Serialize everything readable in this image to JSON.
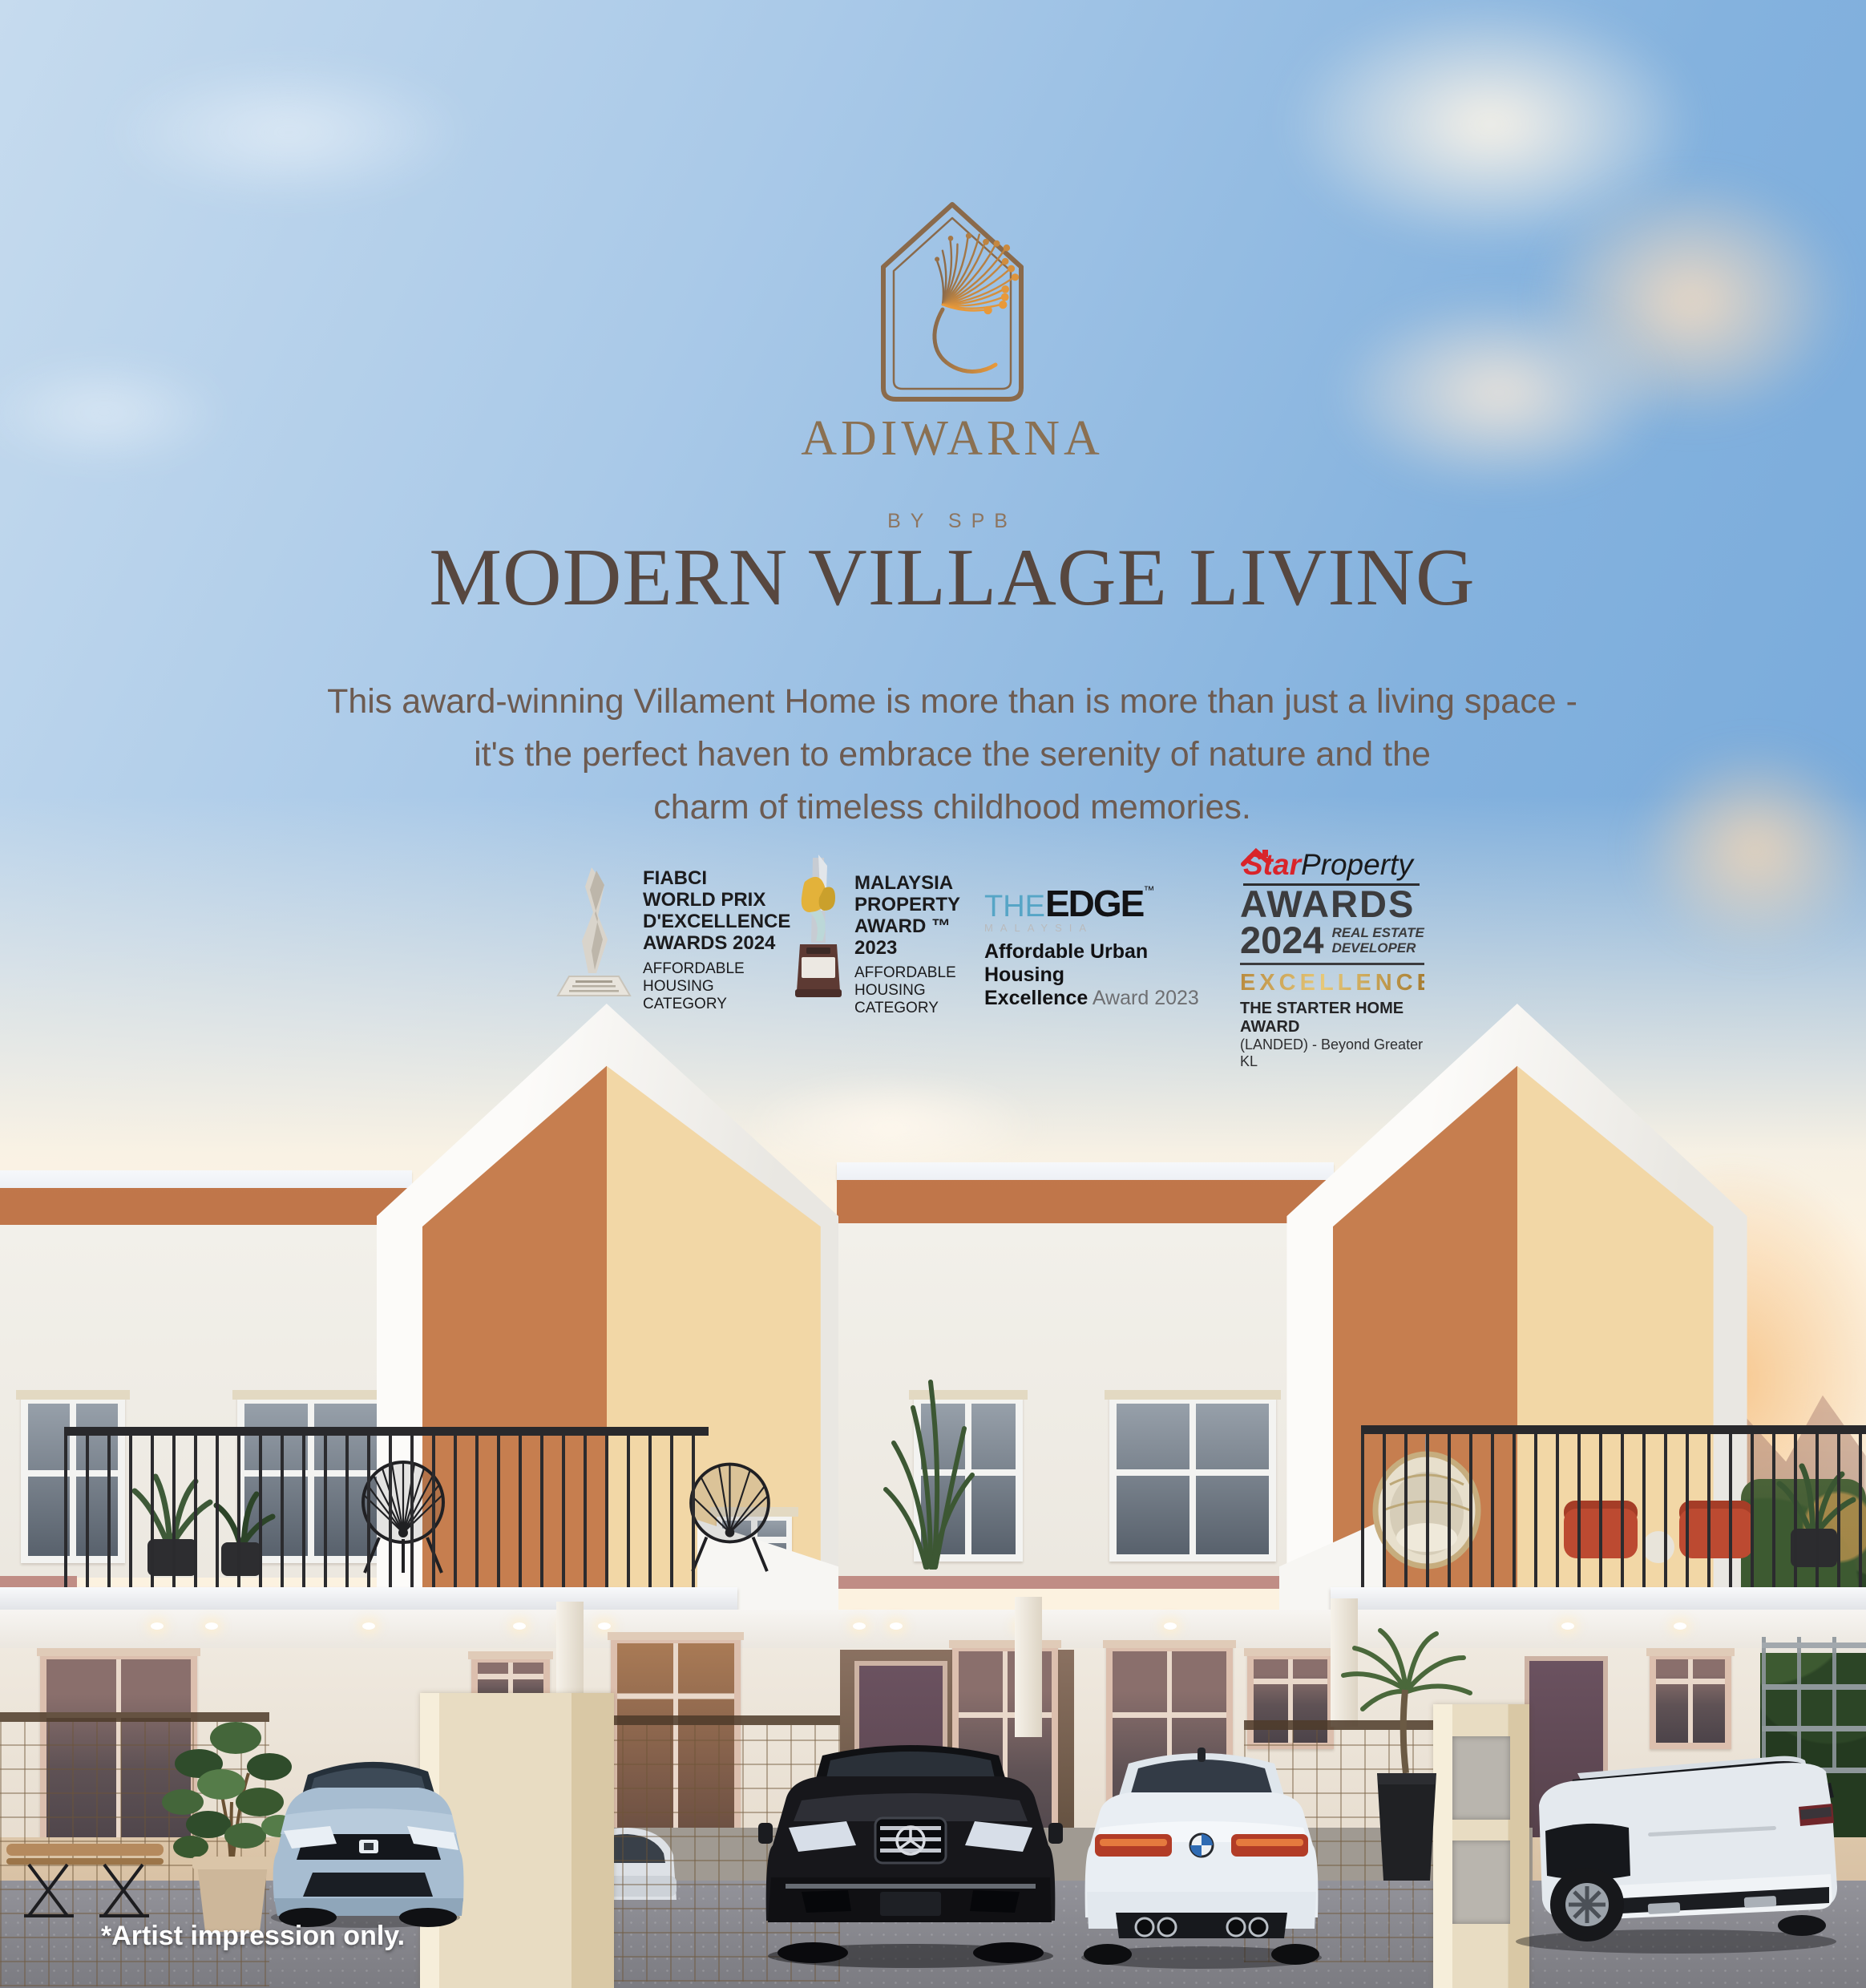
{
  "brand": {
    "name": "ADIWARNA",
    "byline": "BY SPB"
  },
  "headline": "MODERN VILLAGE LIVING",
  "tagline_lines": [
    "This award-winning Villament Home is more than is more than just a living space -",
    "it's the perfect haven to embrace the serenity of nature and the",
    "charm of timeless childhood memories."
  ],
  "awards": {
    "fiabci": {
      "title_lines": [
        "FIABCI",
        "WORLD PRIX",
        "D'EXCELLENCE",
        "AWARDS 2024"
      ],
      "category_lines": [
        "AFFORDABLE",
        "HOUSING",
        "CATEGORY"
      ]
    },
    "malaysia_property": {
      "title_lines": [
        "MALAYSIA",
        "PROPERTY",
        "AWARD ™",
        "2023"
      ],
      "category_lines": [
        "AFFORDABLE",
        "HOUSING",
        "CATEGORY"
      ]
    },
    "the_edge": {
      "the": "THE",
      "edge": "EDGE",
      "tm": "™",
      "malaysia": "MALAYSIA",
      "line1": "Affordable Urban Housing",
      "line2_bold": "Excellence",
      "line2_rest": " Award 2023"
    },
    "star_property": {
      "star": "Star",
      "property": "Property",
      "awards": "AWARDS",
      "year": "2024",
      "developer_line1": "REAL ESTATE",
      "developer_line2": "DEVELOPER",
      "tier": "EXCELLENCE",
      "award_name": "THE STARTER HOME AWARD",
      "award_detail": "(LANDED) - Beyond Greater KL"
    }
  },
  "footnote": "*Artist impression only.",
  "palette": {
    "sky_top": "#c6dbee",
    "sky_deep": "#6fa4d8",
    "sky_horizon": "#fdf3e2",
    "cloud_peach": "#f7ddc1",
    "sunset_orange": "#f5c49a",
    "logo_brown": "#8a6a4b",
    "logo_orange": "#e8993a",
    "brand_text": "#8a7052",
    "byline_text": "#8d7560",
    "heading_text": "#57473f",
    "body_text": "#6d5b51",
    "award_text": "#1b1b1d",
    "award_gray": "#6e6f72",
    "edge_blue": "#56a5c6",
    "star_red": "#d9242a",
    "gold": "#c39a4e",
    "facade_white": "#f2f0ea",
    "parapet_white": "#edf0f5",
    "terracotta": "#c0764a",
    "gable_orange": "#c67e4f",
    "gable_cream": "#f2d7a6",
    "railing_black": "#2b2b2e",
    "frame_pink": "#dcbfae",
    "band_mauve": "#c08d85",
    "pillar_beige": "#e8dcc2",
    "porch_floor": "#d8c1a4",
    "driveway_gray": "#8d8d91",
    "foliage_green": "#3c5a34"
  }
}
